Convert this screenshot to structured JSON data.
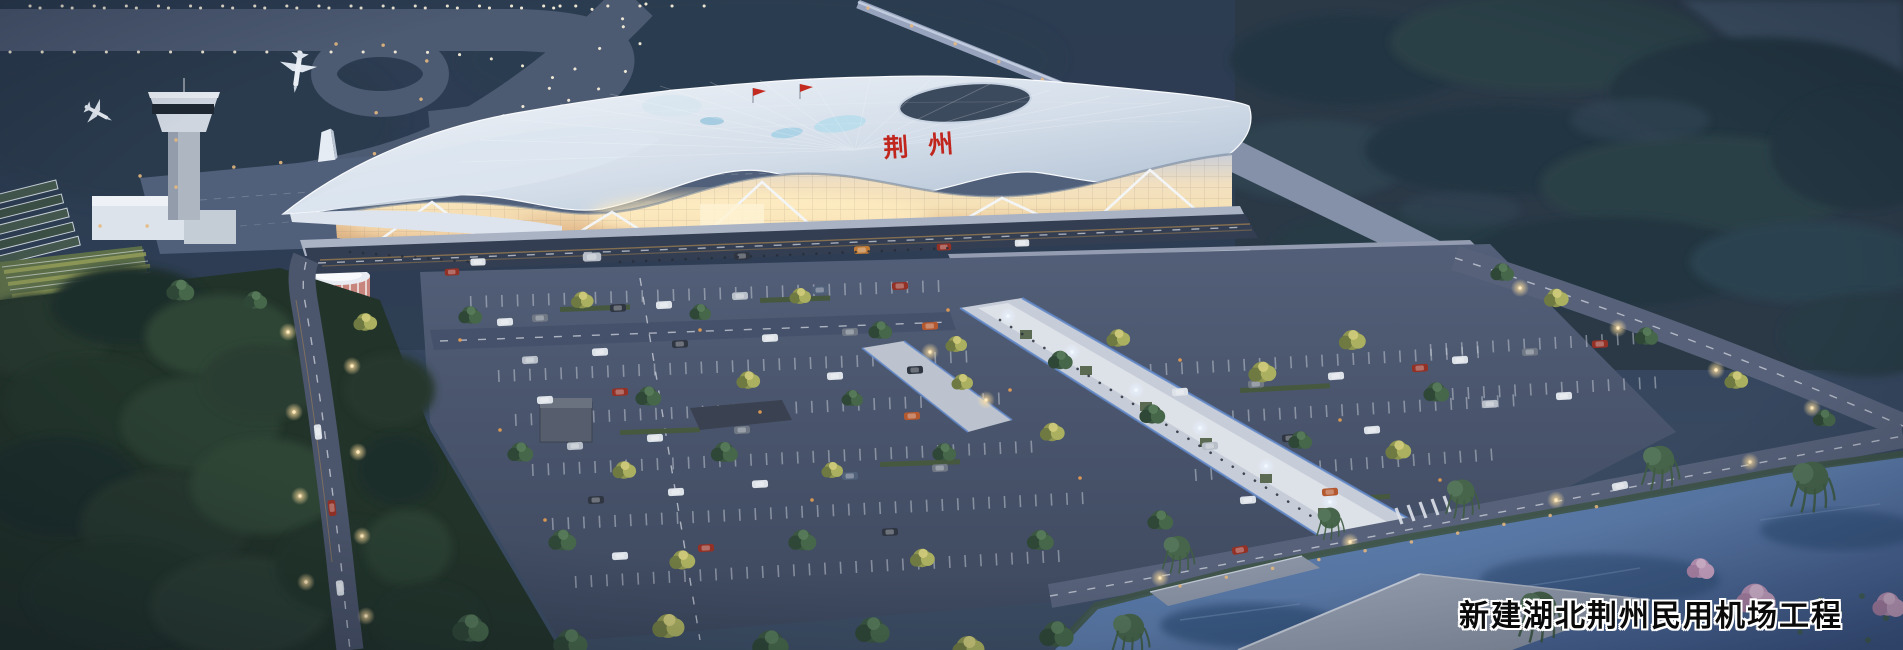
{
  "scene": {
    "caption": {
      "text": "新建湖北荆州民用机场工程"
    },
    "terminal": {
      "roof_signage": "荆州"
    },
    "colors": {
      "sky_top": "#26344a",
      "airfield": "#2e3d52",
      "taxiway": "#4c5a72",
      "perimeter_light": "#98a4be",
      "roof_light": "#f4f7fb",
      "roof_shadow": "#a9bace",
      "glass_warm": "#f6e2b8",
      "glass_deep": "#e2b98b",
      "plaza": "#939cb0",
      "asphalt": "#4d5870",
      "tree_green": "#3b5742",
      "tree_dark": "#243540",
      "tree_autumn": "#a8ad5d",
      "grass_dark": "#2e4434",
      "water": "#52719f",
      "bridge": "#98a2b2",
      "blossom_pink": "#cfa3c6",
      "signage_red": "#c0261d",
      "light_warm": "#ffdf9e",
      "light_cool": "#e8f2ff"
    }
  }
}
